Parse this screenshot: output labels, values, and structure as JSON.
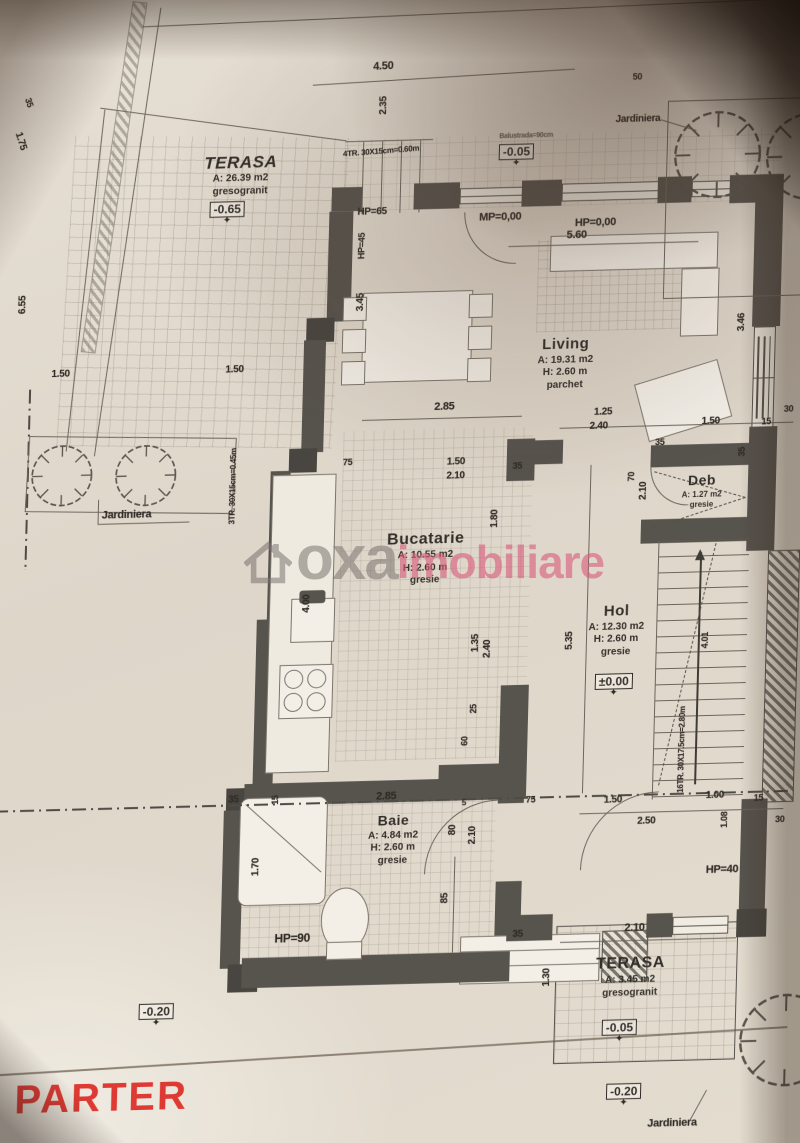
{
  "title": "PARTER",
  "watermark": {
    "name_gray": "oxa",
    "name_pink": "imobiliare"
  },
  "rooms": {
    "terasa_top": {
      "name": "TERASA",
      "area": "A: 26.39 m2",
      "floor": "gresogranit"
    },
    "living": {
      "name": "Living",
      "area": "A: 19.31 m2",
      "height": "H: 2.60 m",
      "floor": "parchet"
    },
    "bucatarie": {
      "name": "Bucatarie",
      "area": "A: 10.55 m2",
      "height": "H: 2.60 m",
      "floor": "gresie"
    },
    "hol": {
      "name": "Hol",
      "area": "A: 12.30 m2",
      "height": "H: 2.60 m",
      "floor": "gresie"
    },
    "deb": {
      "name": "Deb",
      "area": "A: 1.27 m2",
      "floor": "gresie"
    },
    "baie": {
      "name": "Baie",
      "area": "A: 4.84 m2",
      "height": "H: 2.60 m",
      "floor": "gresie"
    },
    "terasa_bottom": {
      "name": "TERASA",
      "area": "A: 3.45 m2",
      "floor": "gresogranit"
    }
  },
  "levels": {
    "terasa_top": "-0.65",
    "front": "-0.05",
    "hol": "±0.00",
    "bottom_left": "-0.20",
    "terasa_bottom": "-0.05",
    "ground": "-0.20"
  },
  "labels": {
    "jardiniera_left": "Jardiniera",
    "jardiniera_top": "Jardiniera",
    "jardiniera_bottom": "Jardiniera"
  },
  "stairs": {
    "top": "4TR. 30X15cm=0.60m",
    "left": "3TR. 30X15cm=0.45m",
    "main": "16TR. 30X17.5cm=2.80m",
    "main2": "4.01"
  },
  "headers": {
    "hp65": "HP=65",
    "mp000": "MP=0,00",
    "hp000": "HP=0,00",
    "hp45": "HP=45",
    "hp90": "HP=90",
    "hp40": "HP=40",
    "balustrade": "Balustrada=90cm"
  },
  "dims": {
    "a450": "4.50",
    "a50": "50",
    "a235": "2.35",
    "a175": "1.75",
    "a35": "35",
    "a655": "6.55",
    "a150l": "1.50",
    "a150r": "1.50",
    "a560": "5.60",
    "a285liv": "2.85",
    "a125": "1.25",
    "a240liv": "2.40",
    "a150liv": "1.50",
    "a15liv": "15",
    "a346": "3.46",
    "a30liv": "30",
    "a75kit": "75",
    "a150kit": "1.50",
    "a210kit": "2.10",
    "a35kit": "35",
    "a180": "1.80",
    "a345": "3.45",
    "a400": "4.00",
    "a35deb": "35",
    "a70deb": "70",
    "a210deb": "2.10",
    "a35debr": "35",
    "a535": "5.35",
    "a135": "1.35",
    "a240hol": "2.40",
    "a25hol": "25",
    "a60hol": "60",
    "a35ba": "35",
    "a15ba": "15",
    "a285ba": "2.85",
    "a5ba": "5",
    "a80ba": "80",
    "a210ba": "2.10",
    "a75ba": "75",
    "a170": "1.70",
    "a85": "85",
    "a35bb": "35",
    "a150en": "1.50",
    "a250en": "2.50",
    "a100en": "1.00",
    "a15en": "15",
    "a108": "1.08",
    "a30en": "30",
    "a210bt": "2.10",
    "a130bt": "1.30"
  },
  "colors": {
    "wall": "#57534d",
    "ink": "#2f2b26",
    "paper": "#e0d8cc",
    "title_red": "#de3a33",
    "watermark_pink": "#d85c7a",
    "watermark_gray": "#787470"
  }
}
